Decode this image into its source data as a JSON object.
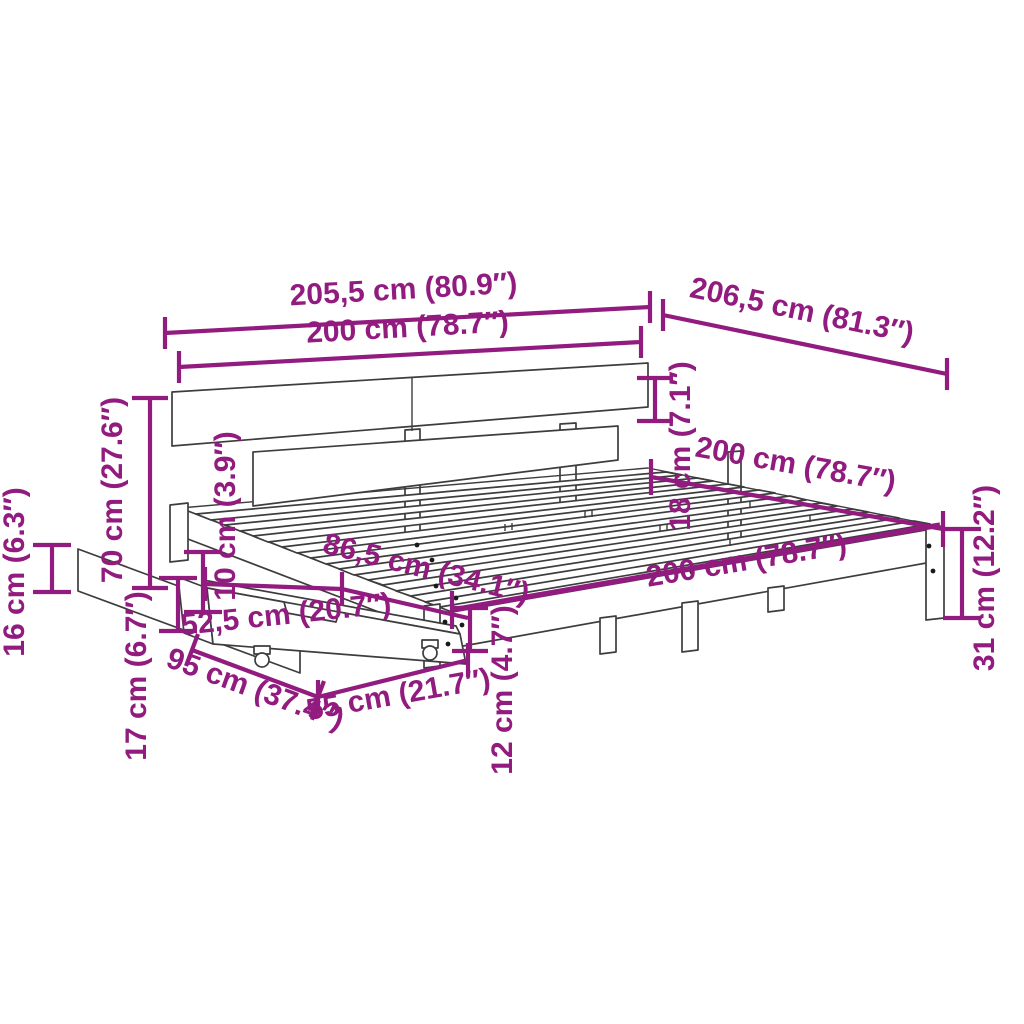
{
  "diagram": {
    "kind": "product-dimension-diagram",
    "product": "bed-frame-with-headboard-and-underbed-drawer",
    "background_color": "#FFFFFF",
    "outline_color": "#3D3D3D",
    "accent_color": "#911B7E",
    "dimensions": [
      {
        "id": "overall-width",
        "label": "205,5 cm (80.9″)"
      },
      {
        "id": "headboard-width",
        "label": "200 cm (78.7″)"
      },
      {
        "id": "overall-length",
        "label": "206,5 cm (81.3″)"
      },
      {
        "id": "headboard-board-height",
        "label": "18 cm (7.1″)"
      },
      {
        "id": "bed-length-top",
        "label": "200 cm (78.7″)"
      },
      {
        "id": "headboard-height",
        "label": "70 cm (27.6″)"
      },
      {
        "id": "under-rail-clearance",
        "label": "10 cm (3.9″)"
      },
      {
        "id": "panel-height",
        "label": "16 cm (6.3″)"
      },
      {
        "id": "drawer-side-height",
        "label": "17 cm (6.7″)"
      },
      {
        "id": "drawer-span",
        "label": "86,5 cm (34.1″)"
      },
      {
        "id": "drawer-front-width",
        "label": "52,5 cm (20.7″)"
      },
      {
        "id": "bed-length-rail",
        "label": "200 cm (78.7″)"
      },
      {
        "id": "drawer-depth",
        "label": "95 cm (37.4″)"
      },
      {
        "id": "drawer-width",
        "label": "55 cm (21.7″)"
      },
      {
        "id": "drawer-height",
        "label": "12 cm (4.7″)"
      },
      {
        "id": "frame-height",
        "label": "31 cm (12.2″)"
      }
    ]
  }
}
